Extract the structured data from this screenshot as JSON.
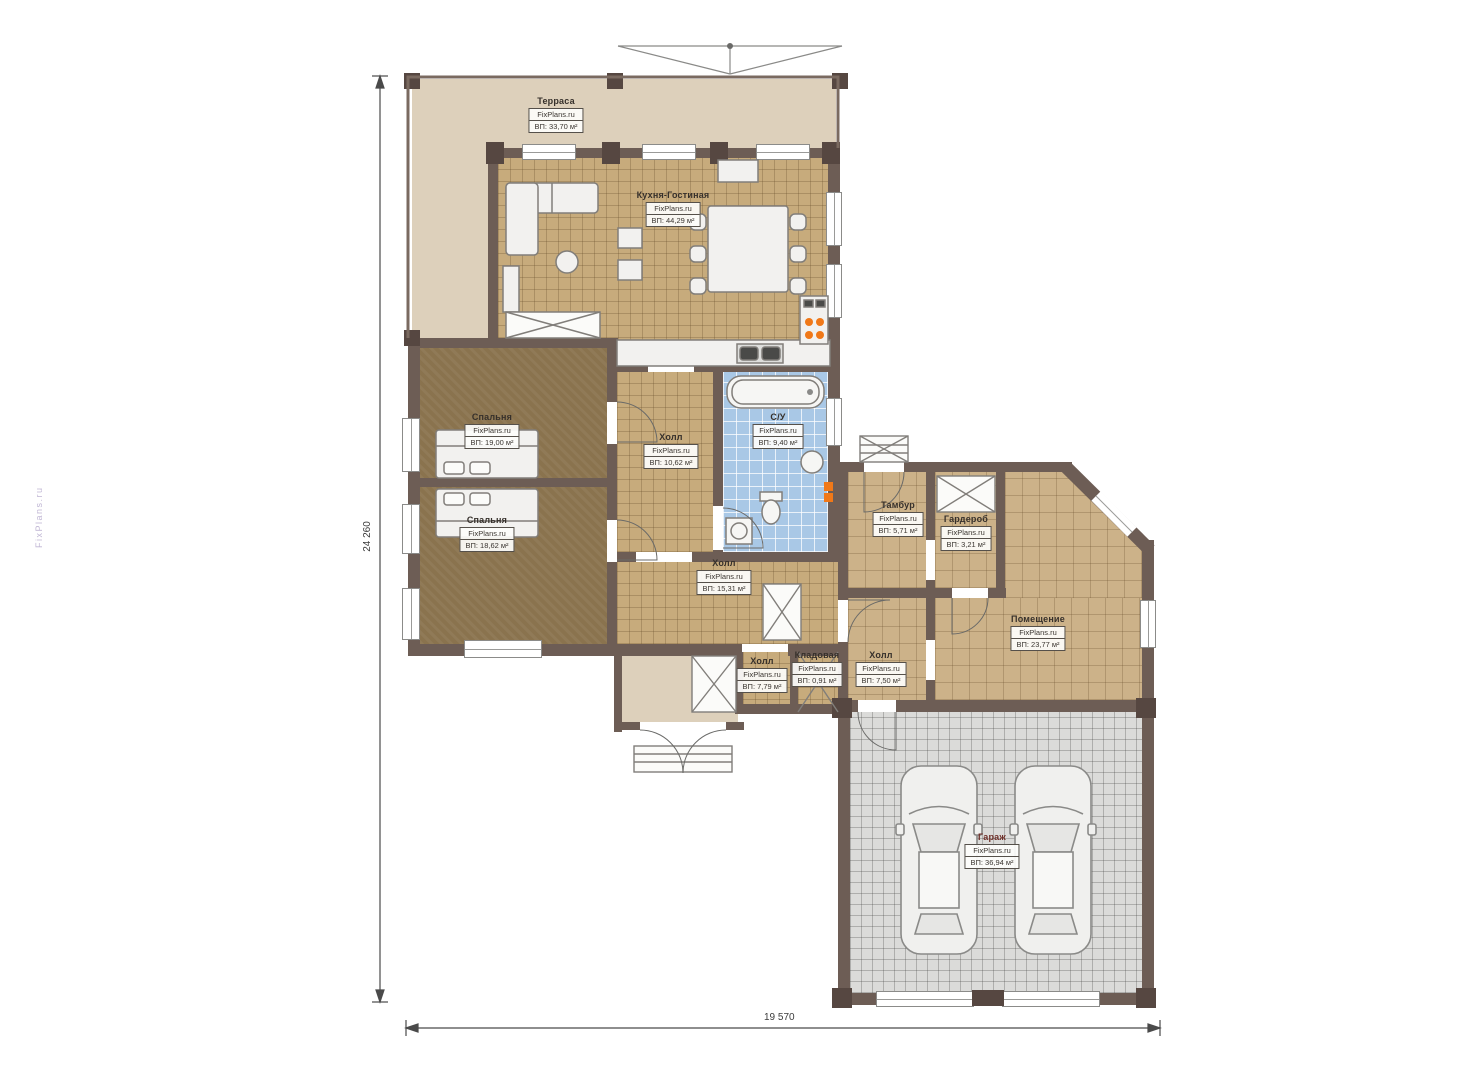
{
  "watermark": "FixPlans.ru",
  "dimensions": {
    "vertical": "24 260",
    "horizontal": "19 570"
  },
  "rooms": [
    {
      "name": "Терраса",
      "brand": "FixPlans.ru",
      "area": "ВП: 33,70 м²"
    },
    {
      "name": "Кухня-Гостиная",
      "brand": "FixPlans.ru",
      "area": "ВП: 44,29 м²"
    },
    {
      "name": "Спальня",
      "brand": "FixPlans.ru",
      "area": "ВП: 19,00 м²"
    },
    {
      "name": "Спальня",
      "brand": "FixPlans.ru",
      "area": "ВП: 18,62 м²"
    },
    {
      "name": "Холл",
      "brand": "FixPlans.ru",
      "area": "ВП: 10,62 м²"
    },
    {
      "name": "С/У",
      "brand": "FixPlans.ru",
      "area": "ВП: 9,40 м²"
    },
    {
      "name": "Холл",
      "brand": "FixPlans.ru",
      "area": "ВП: 15,31 м²"
    },
    {
      "name": "Тамбур",
      "brand": "FixPlans.ru",
      "area": "ВП: 5,71 м²"
    },
    {
      "name": "Гардероб",
      "brand": "FixPlans.ru",
      "area": "ВП: 3,21 м²"
    },
    {
      "name": "Помещение",
      "brand": "FixPlans.ru",
      "area": "ВП: 23,77 м²"
    },
    {
      "name": "Холл",
      "brand": "FixPlans.ru",
      "area": "ВП: 7,79 м²"
    },
    {
      "name": "Кладовая",
      "brand": "FixPlans.ru",
      "area": "ВП: 0,91 м²"
    },
    {
      "name": "Холл",
      "brand": "FixPlans.ru",
      "area": "ВП: 7,50 м²"
    },
    {
      "name": "Гараж",
      "brand": "FixPlans.ru",
      "area": "ВП: 36,94 м²"
    }
  ],
  "colors": {
    "wall": "#6d5d55",
    "floor_tile_tan": "#c7ab7c",
    "floor_bedroom": "#8a734e",
    "floor_bath": "#a9c8e6",
    "floor_garage": "#dbdbd9",
    "floor_terrace": "#ddd0bb",
    "stove_accent": "#f07818",
    "dimension_line": "#4a4a4a"
  }
}
